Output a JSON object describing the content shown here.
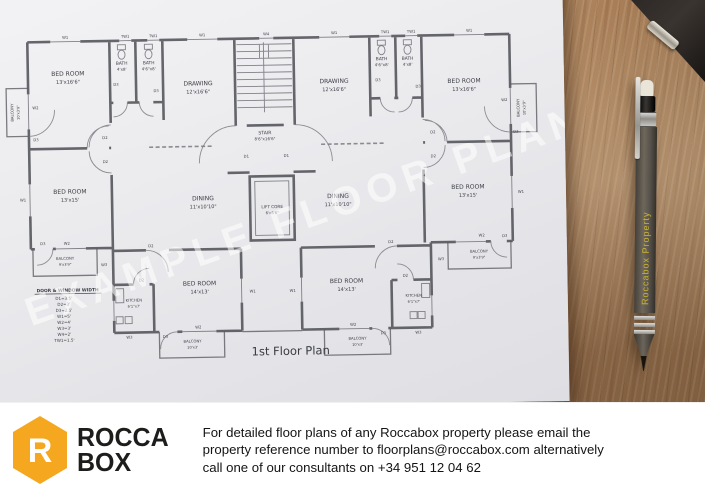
{
  "plan": {
    "title": "1st Floor Plan",
    "watermark": "EXAMPLE FLOOR PLAN",
    "legend": {
      "title": "DOOR & WINDOW WIDTH",
      "entries": [
        "D1=3.5'",
        "D2=3'",
        "D3=2.5'",
        "W1=5'",
        "W2=4'",
        "W3=3'",
        "W4=2'",
        "TW1=1.5'"
      ]
    },
    "labels": [
      {
        "t": "BED ROOM",
        "x": 70,
        "y": 72,
        "fs": 6
      },
      {
        "t": "13'x16'6\"",
        "x": 70,
        "y": 80,
        "fs": 5
      },
      {
        "t": "BATH",
        "x": 124,
        "y": 62,
        "fs": 4.4
      },
      {
        "t": "4'x8'",
        "x": 124,
        "y": 68,
        "fs": 4
      },
      {
        "t": "BATH",
        "x": 151,
        "y": 62,
        "fs": 4.4
      },
      {
        "t": "4'6\"x8'",
        "x": 151,
        "y": 68,
        "fs": 4
      },
      {
        "t": "DRAWING",
        "x": 200,
        "y": 84,
        "fs": 6
      },
      {
        "t": "12'x16'6\"",
        "x": 200,
        "y": 92,
        "fs": 5
      },
      {
        "t": "STAIR",
        "x": 266,
        "y": 134,
        "fs": 4.6
      },
      {
        "t": "8'6\"x16'6\"",
        "x": 266,
        "y": 140,
        "fs": 4
      },
      {
        "t": "DRAWING",
        "x": 336,
        "y": 84,
        "fs": 6
      },
      {
        "t": "12'x16'6\"",
        "x": 336,
        "y": 92,
        "fs": 5
      },
      {
        "t": "BATH",
        "x": 384,
        "y": 62,
        "fs": 4.4
      },
      {
        "t": "4'6\"x8'",
        "x": 384,
        "y": 68,
        "fs": 4
      },
      {
        "t": "BATH",
        "x": 410,
        "y": 62,
        "fs": 4.4
      },
      {
        "t": "4'x8'",
        "x": 410,
        "y": 68,
        "fs": 4
      },
      {
        "t": "BED ROOM",
        "x": 466,
        "y": 86,
        "fs": 6
      },
      {
        "t": "13'x16'6\"",
        "x": 466,
        "y": 94,
        "fs": 5
      },
      {
        "t": "BALCONY",
        "x": 15,
        "y": 108,
        "fs": 3.8,
        "r": -90
      },
      {
        "t": "10'x3'9\"",
        "x": 21,
        "y": 108,
        "fs": 3.6,
        "r": -90
      },
      {
        "t": "BALCONY",
        "x": 521,
        "y": 112,
        "fs": 3.8,
        "r": -90
      },
      {
        "t": "10'x3'9\"",
        "x": 527,
        "y": 112,
        "fs": 3.6,
        "r": -90
      },
      {
        "t": "BED ROOM",
        "x": 70,
        "y": 190,
        "fs": 6
      },
      {
        "t": "13'x15'",
        "x": 70,
        "y": 198,
        "fs": 5
      },
      {
        "t": "DINING",
        "x": 203,
        "y": 199,
        "fs": 6
      },
      {
        "t": "11'x10'10\"",
        "x": 203,
        "y": 207,
        "fs": 5
      },
      {
        "t": "LIFT CORE",
        "x": 272,
        "y": 208,
        "fs": 4.2
      },
      {
        "t": "6'x6'6\"",
        "x": 272,
        "y": 214,
        "fs": 3.8
      },
      {
        "t": "DINING",
        "x": 338,
        "y": 199,
        "fs": 6
      },
      {
        "t": "11'x10'10\"",
        "x": 338,
        "y": 207,
        "fs": 5
      },
      {
        "t": "BED ROOM",
        "x": 468,
        "y": 192,
        "fs": 6
      },
      {
        "t": "13'x15'",
        "x": 468,
        "y": 200,
        "fs": 5
      },
      {
        "t": "BALCONY",
        "x": 64,
        "y": 256,
        "fs": 3.8
      },
      {
        "t": "9'x3'9\"",
        "x": 64,
        "y": 262,
        "fs": 3.6
      },
      {
        "t": "BALCONY",
        "x": 478,
        "y": 256,
        "fs": 3.8
      },
      {
        "t": "9'x3'9\"",
        "x": 478,
        "y": 262,
        "fs": 3.6
      },
      {
        "t": "KITCHEN",
        "x": 132,
        "y": 299,
        "fs": 3.8
      },
      {
        "t": "6'1\"x7'",
        "x": 132,
        "y": 305,
        "fs": 3.6
      },
      {
        "t": "KITCHEN",
        "x": 412,
        "y": 299,
        "fs": 3.8
      },
      {
        "t": "6'1\"x7'",
        "x": 412,
        "y": 305,
        "fs": 3.6
      },
      {
        "t": "BED ROOM",
        "x": 198,
        "y": 284,
        "fs": 6
      },
      {
        "t": "14'x13'",
        "x": 198,
        "y": 292,
        "fs": 5
      },
      {
        "t": "BED ROOM",
        "x": 345,
        "y": 284,
        "fs": 6
      },
      {
        "t": "14'x13'",
        "x": 345,
        "y": 292,
        "fs": 5
      },
      {
        "t": "BALCONY",
        "x": 190,
        "y": 341,
        "fs": 3.8
      },
      {
        "t": "10'x3'",
        "x": 190,
        "y": 347,
        "fs": 3.6
      },
      {
        "t": "BALCONY",
        "x": 355,
        "y": 341,
        "fs": 3.8
      },
      {
        "t": "10'x3'",
        "x": 355,
        "y": 347,
        "fs": 3.6
      },
      {
        "t": "W1",
        "x": 68,
        "y": 35,
        "fs": 3.8
      },
      {
        "t": "TW1",
        "x": 128,
        "y": 35,
        "fs": 3.8
      },
      {
        "t": "TW1",
        "x": 156,
        "y": 35,
        "fs": 3.8
      },
      {
        "t": "W1",
        "x": 205,
        "y": 35,
        "fs": 3.8
      },
      {
        "t": "W4",
        "x": 269,
        "y": 35,
        "fs": 3.8
      },
      {
        "t": "W1",
        "x": 337,
        "y": 35,
        "fs": 3.8
      },
      {
        "t": "TW1",
        "x": 388,
        "y": 35,
        "fs": 3.8
      },
      {
        "t": "TW1",
        "x": 414,
        "y": 35,
        "fs": 3.8
      },
      {
        "t": "W1",
        "x": 472,
        "y": 35,
        "fs": 3.8
      },
      {
        "t": "W2",
        "x": 37,
        "y": 105,
        "fs": 3.8
      },
      {
        "t": "D3",
        "x": 37,
        "y": 137,
        "fs": 3.8
      },
      {
        "t": "W1",
        "x": 23,
        "y": 197,
        "fs": 3.8
      },
      {
        "t": "D3",
        "x": 42,
        "y": 241,
        "fs": 3.8
      },
      {
        "t": "D2",
        "x": 106,
        "y": 136,
        "fs": 3.8
      },
      {
        "t": "D2",
        "x": 106,
        "y": 160,
        "fs": 3.8
      },
      {
        "t": "D3",
        "x": 118,
        "y": 83,
        "fs": 3.8
      },
      {
        "t": "D3",
        "x": 158,
        "y": 90,
        "fs": 3.8
      },
      {
        "t": "D1",
        "x": 247,
        "y": 157,
        "fs": 3.8
      },
      {
        "t": "D1",
        "x": 287,
        "y": 157,
        "fs": 3.8
      },
      {
        "t": "D3",
        "x": 380,
        "y": 83,
        "fs": 3.8
      },
      {
        "t": "D3",
        "x": 420,
        "y": 90,
        "fs": 3.8
      },
      {
        "t": "D2",
        "x": 434,
        "y": 136,
        "fs": 3.8
      },
      {
        "t": "D2",
        "x": 434,
        "y": 160,
        "fs": 3.8
      },
      {
        "t": "W2",
        "x": 506,
        "y": 105,
        "fs": 3.8
      },
      {
        "t": "D3",
        "x": 517,
        "y": 137,
        "fs": 3.8
      },
      {
        "t": "W1",
        "x": 521,
        "y": 197,
        "fs": 3.8
      },
      {
        "t": "W2",
        "x": 481,
        "y": 240,
        "fs": 3.8
      },
      {
        "t": "D3",
        "x": 504,
        "y": 241,
        "fs": 3.8
      },
      {
        "t": "W2",
        "x": 66,
        "y": 241,
        "fs": 3.8
      },
      {
        "t": "W3",
        "x": 103,
        "y": 263,
        "fs": 3.8
      },
      {
        "t": "W3",
        "x": 440,
        "y": 263,
        "fs": 3.8
      },
      {
        "t": "D2",
        "x": 150,
        "y": 245,
        "fs": 3.8
      },
      {
        "t": "D2",
        "x": 390,
        "y": 245,
        "fs": 3.8
      },
      {
        "t": "D2",
        "x": 140,
        "y": 279,
        "fs": 3.8
      },
      {
        "t": "D2",
        "x": 404,
        "y": 279,
        "fs": 3.8
      },
      {
        "t": "W1",
        "x": 251,
        "y": 292,
        "fs": 3.8
      },
      {
        "t": "W1",
        "x": 291,
        "y": 292,
        "fs": 3.8
      },
      {
        "t": "W2",
        "x": 196,
        "y": 327,
        "fs": 3.8
      },
      {
        "t": "W2",
        "x": 351,
        "y": 327,
        "fs": 3.8
      },
      {
        "t": "D3",
        "x": 163,
        "y": 336,
        "fs": 3.8
      },
      {
        "t": "D3",
        "x": 381,
        "y": 336,
        "fs": 3.8
      },
      {
        "t": "W3",
        "x": 127,
        "y": 336,
        "fs": 3.8
      },
      {
        "t": "W3",
        "x": 416,
        "y": 336,
        "fs": 3.8
      }
    ]
  },
  "pencil": {
    "text": "Roccabox Property"
  },
  "footer": {
    "brand": {
      "line1": "ROCCA",
      "line2": "BOX",
      "logo_color": "#F4A71F",
      "r_glyph": "R"
    },
    "text_lines": [
      "For detailed floor plans of any Roccabox property please email the",
      "property reference number to floorplans@roccabox.com alternatively",
      "call one of our consultants on +34 951 12 04 62"
    ]
  }
}
